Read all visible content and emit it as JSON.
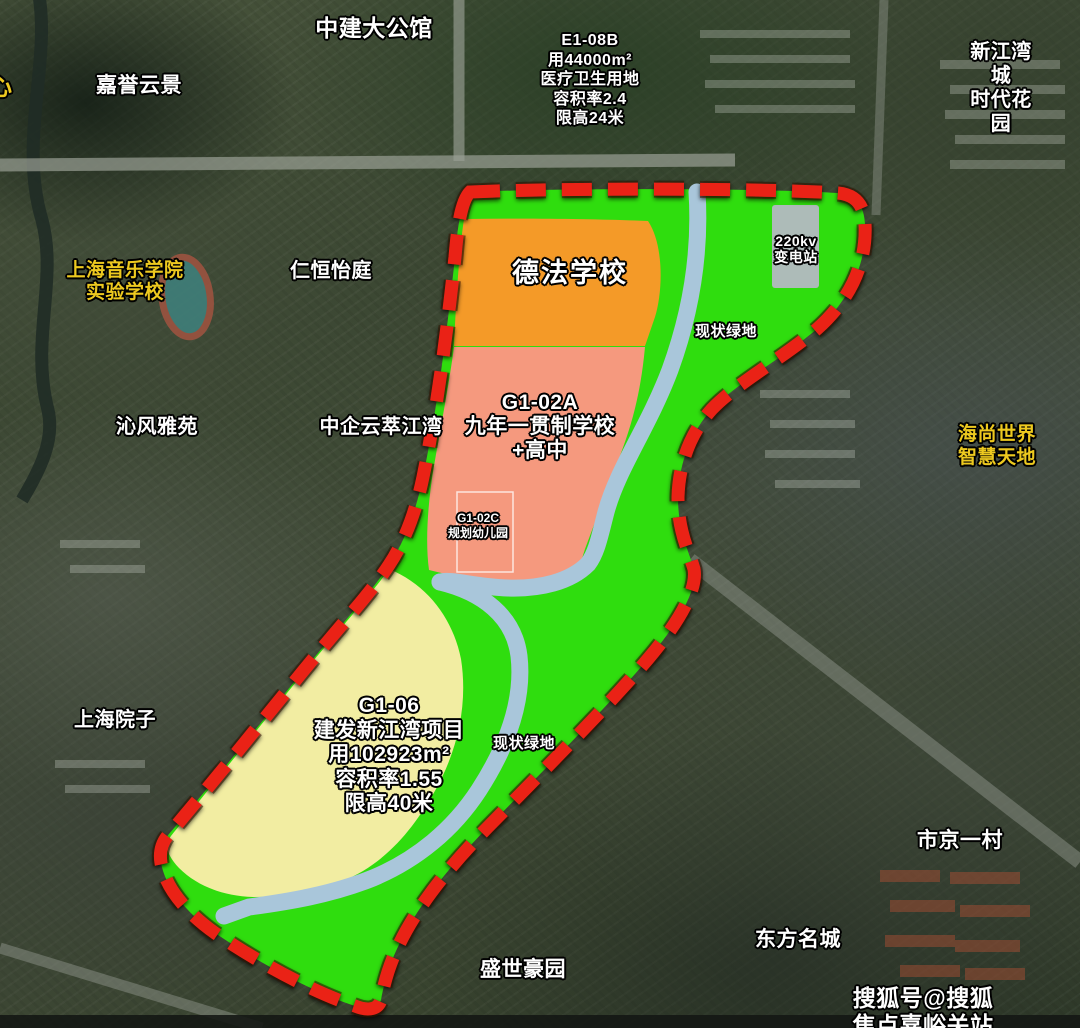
{
  "map": {
    "watermark": "搜狐号@搜狐焦点嘉峪关站",
    "colors": {
      "boundary_red": "#ea2418",
      "green_space": "#2fdd0e",
      "orange_school": "#f49a28",
      "pink_school": "#f5997e",
      "yellow_project": "#f2eda2",
      "river_blue": "#a9c6da",
      "substation_gray": "#b4b8c2",
      "label_white": "#ffffff",
      "label_yellow": "#edc91f"
    },
    "parcels": {
      "e1_08b": "E1-08B\n用44000m²\n医疗卫生用地\n容积率2.4\n限高24米",
      "defa_school": "德法学校",
      "g1_02a": "G1-02A\n九年一贯制学校\n+高中",
      "g1_02c": "G1-02C\n规划幼儿园",
      "g1_06": "G1-06\n建发新江湾项目\n用102923m²\n容积率1.55\n限高40米",
      "substation": "220kv\n变电站",
      "green_upper": "现状绿地",
      "green_lower": "现状绿地"
    },
    "region_labels": {
      "zhongjian_da_gongguan": "中建大公馆",
      "jiayu_yunjing": "嘉誉云景",
      "xinjiangwan_times_garden": "新江湾城\n时代花园",
      "partial_left": "心",
      "conservatory": "上海音乐学院\n实验学校",
      "renheng_yiting": "仁恒怡庭",
      "qinfeng_yayuan": "沁风雅苑",
      "zhongqi_yuncui": "中企云萃江湾",
      "haishang_world": "海尚世界\n智慧天地",
      "shanghai_yuanzi": "上海院子",
      "shijing_yicun": "市京一村",
      "dongfang_mingcheng": "东方名城",
      "shengshi_haoyuan": "盛世豪园"
    }
  }
}
